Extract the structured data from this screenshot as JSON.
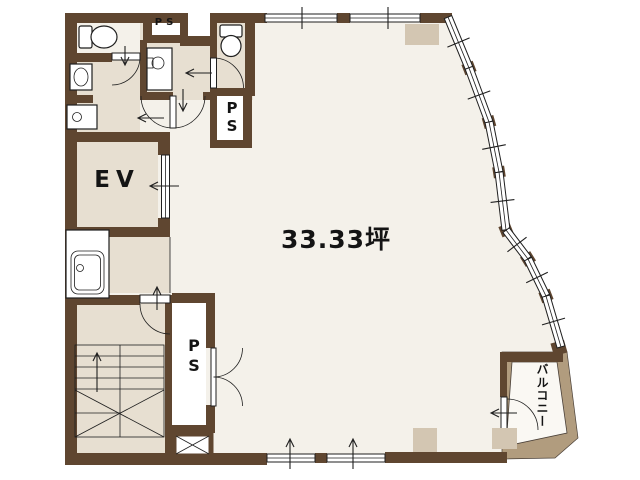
{
  "plan": {
    "labels": {
      "area": "33.33坪",
      "elevator": "EV",
      "pipe_shaft": "PS",
      "ps_letters": [
        "P",
        "S"
      ],
      "balcony": "バルコニー"
    },
    "colors": {
      "background": "#ffffff",
      "floor": "#f4f1ea",
      "room": "#e7dfd1",
      "wall": "#5f4630",
      "pillar": "#d3c6b2",
      "balcony_wall": "#b19c7e",
      "line": "#1f1f1f"
    }
  }
}
